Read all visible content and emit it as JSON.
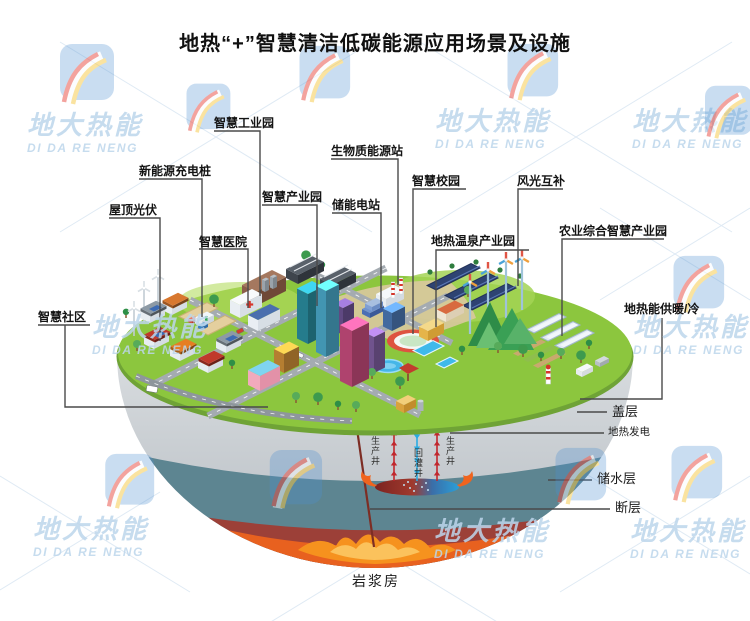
{
  "title": "地热“+”智慧清洁低碳能源应用场景及设施",
  "watermark": {
    "cn": "地大热能",
    "en": "DI DA RE NENG"
  },
  "facility_labels": {
    "smart_industrial_park": "智慧工业园",
    "ev_charging": "新能源充电桩",
    "rooftop_pv": "屋顶光伏",
    "smart_hospital": "智慧医院",
    "smart_industry_park": "智慧产业园",
    "biomass_station": "生物质能源站",
    "storage_station": "储能电站",
    "smart_campus": "智慧校园",
    "wind_solar": "风光互补",
    "hot_spring_park": "地热温泉产业园",
    "agri_park": "农业综合智慧产业园",
    "smart_community": "智慧社区",
    "geo_heating": "地热能供暖/冷"
  },
  "geology_labels": {
    "cap_layer": "盖层",
    "geo_power": "地热发电",
    "aquifer": "储水层",
    "fault": "断层",
    "magma_chamber": "岩浆房"
  },
  "well_labels": {
    "production_left": "生产井",
    "reinjection": "回灌井",
    "production_right": "生产井"
  },
  "colors": {
    "surface_green": "#8cc63e",
    "cap_layer_gray": "#c9ced3",
    "aquifer_teal": "#5d8591",
    "magma_red": "#9c4038",
    "lava_orange": "#e8611f",
    "production_well": "#c1272d",
    "reinjection_well": "#29abe2",
    "leader_line": "#4a4a4a",
    "watermark_blue": "#bdd6ec"
  }
}
